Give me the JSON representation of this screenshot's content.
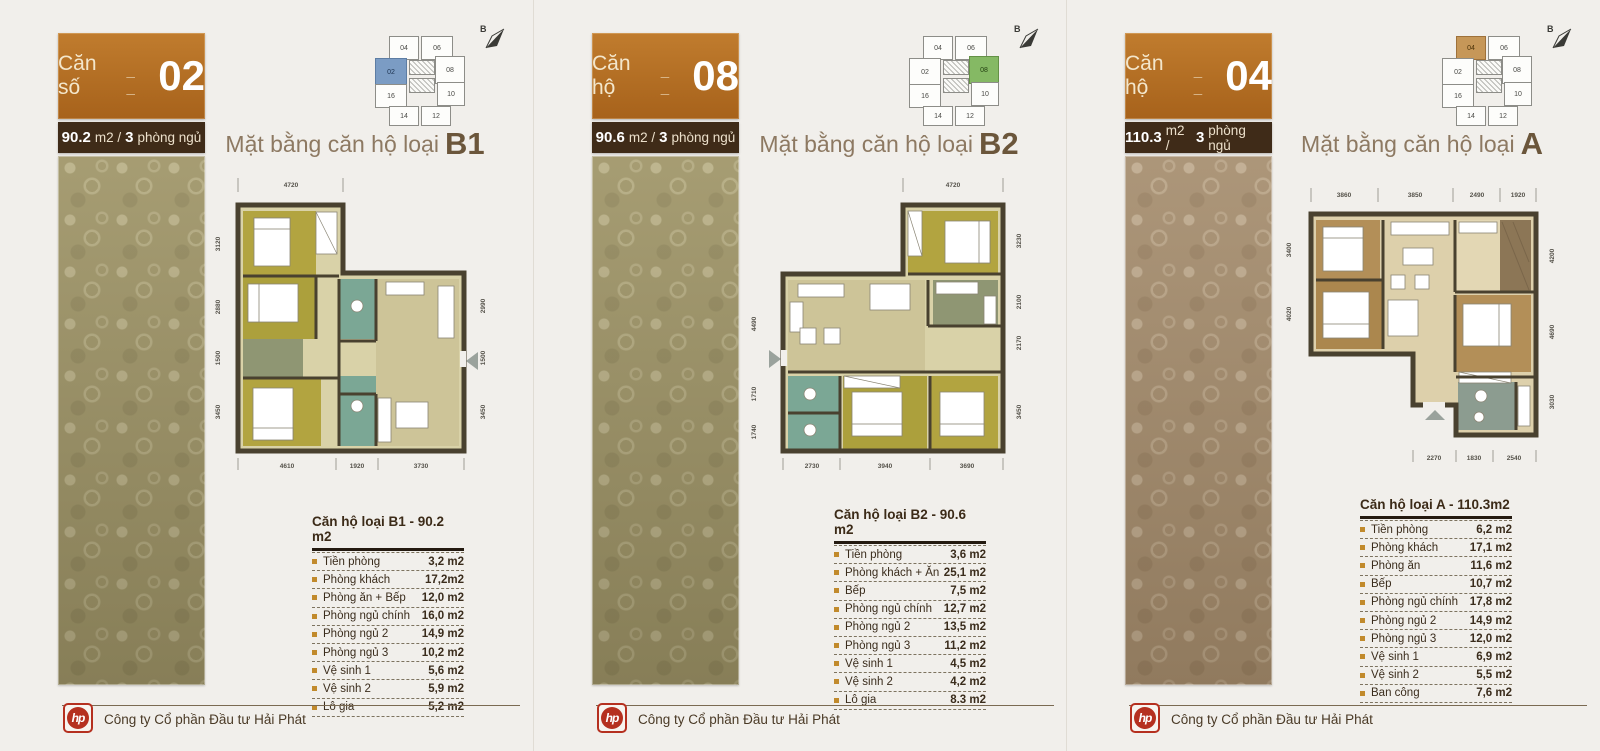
{
  "page": {
    "background": "#f0eeea",
    "footer": {
      "company": "Công ty Cổ phần Đầu tư Hải Phát",
      "logo_text": "hp",
      "logo_color": "#b5301f"
    },
    "palette": {
      "header_orange": "#b1681e",
      "header_dark_brown": "#3f2b18",
      "plan_title_brown": "#8d7962",
      "table_text": "#3a2c1c",
      "bullet_orange": "#c18a2c",
      "wall": "#49412f",
      "room_olive": "#b2a440",
      "room_khaki": "#cdc498",
      "room_floor": "#d9d2a8",
      "room_teal": "#7ba795",
      "room_sage": "#8f9673",
      "room_tan": "#b38f58",
      "room_beige": "#ddd0ab",
      "room_graygreen": "#8c9c90",
      "balcony_brown": "#8c7656",
      "strip_olive": "#9c9266",
      "strip_brown": "#a38b6d",
      "keyplan_highlight_blue": "#7b9cc4",
      "keyplan_highlight_green": "#85b964",
      "keyplan_highlight_tan": "#c69758"
    }
  },
  "panels": [
    {
      "header": {
        "label": "Căn số",
        "blanks": "_ _",
        "number": "02"
      },
      "area_bar": {
        "area": "90.2",
        "mid": "m2 /",
        "beds": "3",
        "beds_label": "phòng ngủ"
      },
      "plan_title": {
        "prefix": "Mặt bằng căn hộ loại",
        "type": "B1"
      },
      "key_plan": {
        "units": [
          "04",
          "06",
          "02",
          "08",
          "16",
          "10",
          "14",
          "12"
        ],
        "highlight": "02",
        "compass": "B"
      },
      "dims": {
        "top": [
          "4720"
        ],
        "left": [
          "3120",
          "2880",
          "1500",
          "3450"
        ],
        "right": [
          "2990",
          "1500",
          "3450"
        ],
        "bottom": [
          "4610",
          "1920",
          "3730"
        ]
      },
      "table": {
        "title": "Căn hộ loại B1 - 90.2 m2",
        "rows": [
          {
            "label": "Tiền phòng",
            "value": "3,2 m2"
          },
          {
            "label": "Phòng khách",
            "value": "17,2m2"
          },
          {
            "label": "Phòng ăn + Bếp",
            "value": "12,0 m2"
          },
          {
            "label": "Phòng ngủ chính",
            "value": "16,0 m2"
          },
          {
            "label": "Phòng ngủ 2",
            "value": "14,9 m2"
          },
          {
            "label": "Phòng ngủ 3",
            "value": "10,2 m2"
          },
          {
            "label": "Vệ sinh 1",
            "value": "5,6 m2"
          },
          {
            "label": "Vệ sinh 2",
            "value": "5,9 m2"
          },
          {
            "label": "Lô gia",
            "value": "5,2 m2"
          }
        ]
      }
    },
    {
      "header": {
        "label": "Căn hộ",
        "blanks": "_ _",
        "number": "08"
      },
      "area_bar": {
        "area": "90.6",
        "mid": "m2 /",
        "beds": "3",
        "beds_label": "phòng ngủ"
      },
      "plan_title": {
        "prefix": "Mặt bằng căn hộ loại",
        "type": "B2"
      },
      "key_plan": {
        "units": [
          "04",
          "06",
          "02",
          "08",
          "16",
          "10",
          "14",
          "12"
        ],
        "highlight": "08",
        "compass": "B"
      },
      "dims": {
        "top": [
          "4720"
        ],
        "left": [
          "4490",
          "1710",
          "1740"
        ],
        "right": [
          "3230",
          "2100",
          "2170",
          "3450"
        ],
        "bottom": [
          "2730",
          "3940",
          "3690"
        ]
      },
      "table": {
        "title": "Căn hộ loại B2 - 90.6 m2",
        "rows": [
          {
            "label": "Tiền phòng",
            "value": "3,6 m2"
          },
          {
            "label": "Phòng khách + Ăn",
            "value": "25,1 m2"
          },
          {
            "label": "Bếp",
            "value": "7,5 m2"
          },
          {
            "label": "Phòng ngủ chính",
            "value": "12,7 m2"
          },
          {
            "label": "Phòng ngủ 2",
            "value": "13,5 m2"
          },
          {
            "label": "Phòng ngủ 3",
            "value": "11,2 m2"
          },
          {
            "label": "Vệ sinh 1",
            "value": "4,5 m2"
          },
          {
            "label": "Vệ sinh 2",
            "value": "4,2 m2"
          },
          {
            "label": "Lô gia",
            "value": "8.3 m2"
          }
        ]
      }
    },
    {
      "header": {
        "label": "Căn hộ",
        "blanks": "_ _",
        "number": "04"
      },
      "area_bar": {
        "area": "110.3",
        "mid": "m2 /",
        "beds": "3",
        "beds_label": "phòng ngủ"
      },
      "plan_title": {
        "prefix": "Mặt bằng căn hộ loại",
        "type": "A"
      },
      "key_plan": {
        "units": [
          "04",
          "06",
          "02",
          "08",
          "16",
          "10",
          "14",
          "12"
        ],
        "highlight": "04",
        "compass": "B"
      },
      "dims": {
        "top": [
          "3860",
          "3850",
          "2490",
          "1920"
        ],
        "left": [
          "3400",
          "4020"
        ],
        "right": [
          "4200",
          "4690",
          "3030"
        ],
        "bottom": [
          "2270",
          "1830",
          "2540"
        ]
      },
      "table": {
        "title": "Căn hộ loại A - 110.3m2",
        "rows": [
          {
            "label": "Tiền phòng",
            "value": "6,2 m2"
          },
          {
            "label": "Phòng khách",
            "value": "17,1 m2"
          },
          {
            "label": "Phòng ăn",
            "value": "11,6 m2"
          },
          {
            "label": "Bếp",
            "value": "10,7 m2"
          },
          {
            "label": "Phòng ngủ chính",
            "value": "17,8 m2"
          },
          {
            "label": "Phòng ngủ 2",
            "value": "14,9 m2"
          },
          {
            "label": "Phòng ngủ 3",
            "value": "12,0 m2"
          },
          {
            "label": "Vệ sinh 1",
            "value": "6,9 m2"
          },
          {
            "label": "Vệ sinh 2",
            "value": "5,5 m2"
          },
          {
            "label": "Ban công",
            "value": "7,6 m2"
          }
        ]
      }
    }
  ]
}
